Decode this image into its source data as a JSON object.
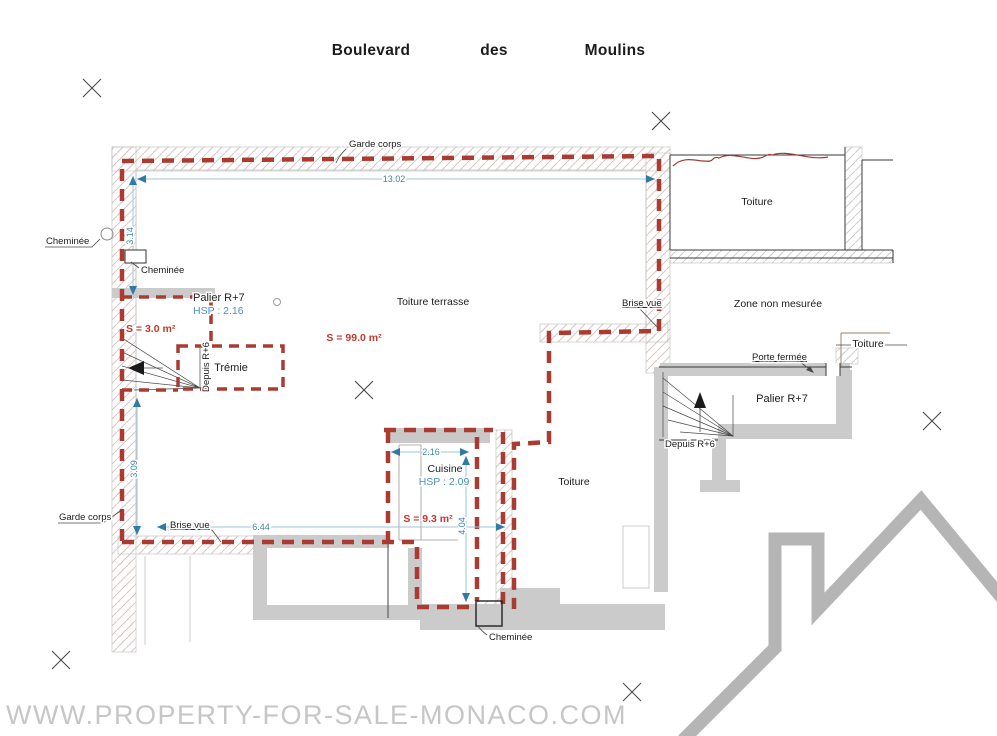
{
  "street_label": {
    "words": [
      "Boulevard",
      "des",
      "Moulins"
    ]
  },
  "watermark": {
    "text": "WWW.PROPERTY-FOR-SALE-MONACO.COM"
  },
  "plan": {
    "rooms": {
      "toiture_terrasse": {
        "name": "Toiture terrasse",
        "area": "S = 99.0 m²"
      },
      "palier_left": {
        "name": "Palier R+7",
        "hsp": "HSP : 2.16",
        "area": "S = 3.0 m²"
      },
      "tremie": {
        "name": "Trémie"
      },
      "cuisine": {
        "name": "Cuisine",
        "hsp": "HSP : 2.09",
        "area": "S = 9.3 m²"
      },
      "toiture_top_right": {
        "name": "Toiture"
      },
      "toiture_mid": {
        "name": "Toiture"
      },
      "toiture_right": {
        "name": "Toiture"
      },
      "zone_non_mesuree": {
        "name": "Zone non mesurée"
      },
      "palier_right": {
        "name": "Palier R+7"
      }
    },
    "annotations": {
      "garde_corps_top": "Garde corps",
      "garde_corps_left": "Garde corps",
      "cheminee_left": "Cheminée",
      "cheminee_left_2": "Cheminée",
      "cheminee_bottom": "Cheminée",
      "brise_vue_right": "Brise vue",
      "brise_vue_bottom": "Brise vue",
      "porte_fermee": "Porte fermée",
      "depuis_r6_left": "Depuis R+6",
      "depuis_r6_right": "Depuis R+6"
    },
    "dimensions": {
      "top_width": "13.02",
      "left_top_height": "3.14",
      "left_bottom_height": "3.09",
      "bottom_width": "6.44",
      "kitchen_width": "2.16",
      "kitchen_height": "4.04"
    },
    "colors": {
      "boundary_red": "#ab3a31",
      "dimension_blue": "#3f86b0",
      "hsp_blue": "#4a90c2",
      "area_red": "#c2392e",
      "wall_gray": "#cbcbcb",
      "hatch_warm": "#d8c7c3",
      "watermark_gray": "#c6c6c6",
      "logo_gray": "#b5b5b5"
    }
  }
}
